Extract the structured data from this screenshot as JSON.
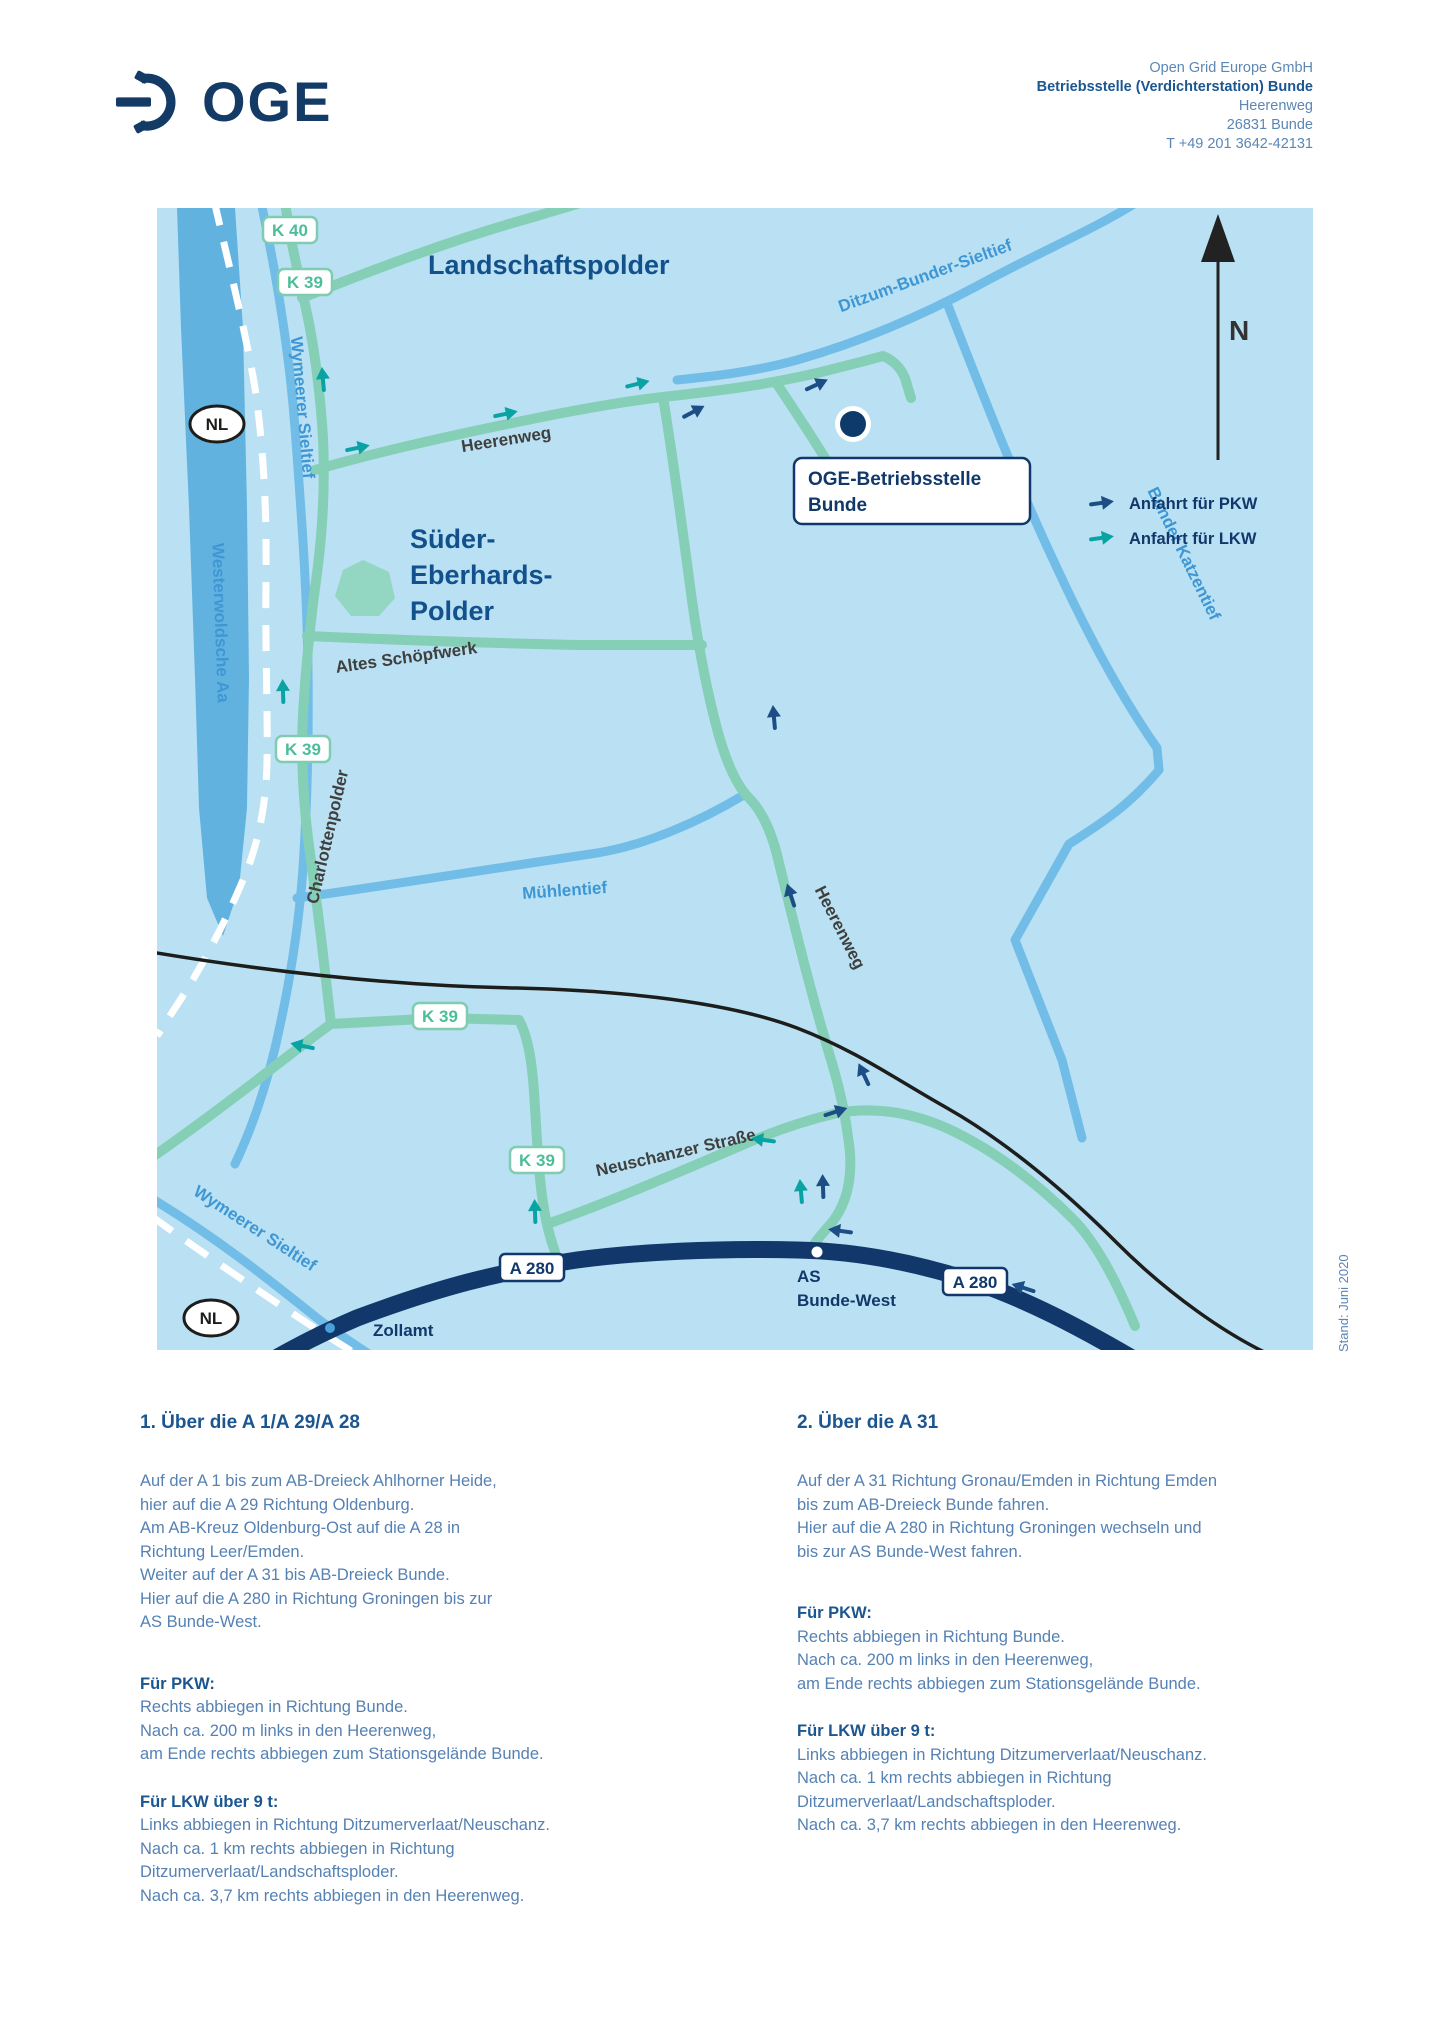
{
  "header": {
    "logo_text": "OGE",
    "address": {
      "line1": "Open Grid Europe GmbH",
      "line2": "Betriebsstelle (Verdichterstation) Bunde",
      "line3": "Heerenweg",
      "line4": "26831 Bunde",
      "line5": "T +49 201 3642-42131"
    }
  },
  "map": {
    "compass_label": "N",
    "legend": {
      "pkw": "Anfahrt für PKW",
      "lkw": "Anfahrt für LKW"
    },
    "region_labels": {
      "landschaftspolder": "Landschaftspolder",
      "sueder_line1": "Süder-",
      "sueder_line2": "Eberhards-",
      "sueder_line3": "Polder"
    },
    "water_labels": {
      "wymeerer_top": "Wymeerer Sieltief",
      "westerwoldsche": "Westerwoldsche Aa",
      "ditzum": "Ditzum-Bunder-Sieltief",
      "katzentief": "Bunder Katzentief",
      "muehlentief": "Mühlentief",
      "wymeerer_bottom": "Wymeerer Sieltief"
    },
    "street_labels": {
      "heerenweg_west": "Heerenweg",
      "heerenweg_south": "Heerenweg",
      "altes_schoepfwerk": "Altes Schöpfwerk",
      "charlottenpolder": "Charlottenpolder",
      "neuschanzer": "Neuschanzer Straße"
    },
    "badges": {
      "k40": "K 40",
      "k39_1": "K 39",
      "k39_2": "K 39",
      "k39_3": "K 39",
      "k39_4": "K 39",
      "a280_1": "A 280",
      "a280_2": "A 280",
      "nl_top": "NL",
      "nl_bottom": "NL"
    },
    "poi": {
      "facility_line1": "OGE-Betriebsstelle",
      "facility_line2": "Bunde",
      "zollamt": "Zollamt",
      "as_line1": "AS",
      "as_line2": "Bunde-West"
    },
    "stand_note": "Stand: Juni 2020"
  },
  "directions": {
    "sections": [
      {
        "heading": "1. Über die A 1/A 29/A 28",
        "intro_lines": [
          "Auf der A 1 bis zum AB-Dreieck Ahlhorner Heide,",
          "hier auf die A 29 Richtung Oldenburg.",
          "Am AB-Kreuz Oldenburg-Ost auf die A 28 in",
          "Richtung Leer/Emden.",
          "Weiter auf der A 31 bis AB-Dreieck Bunde.",
          "Hier auf die A 280 in Richtung Groningen bis zur",
          "AS Bunde-West."
        ],
        "pkw_title": "Für PKW:",
        "pkw_lines": [
          "Rechts abbiegen in Richtung Bunde.",
          "Nach ca. 200 m links in den Heerenweg,",
          "am Ende rechts abbiegen zum Stationsgelände Bunde."
        ],
        "lkw_title": "Für LKW über 9 t:",
        "lkw_lines": [
          "Links abbiegen in Richtung Ditzumerverlaat/Neuschanz.",
          "Nach ca. 1 km rechts abbiegen in Richtung",
          "Ditzumerverlaat/Landschaftsploder.",
          "Nach ca. 3,7 km rechts abbiegen in den Heerenweg."
        ]
      },
      {
        "heading": "2. Über die A 31",
        "intro_lines": [
          "Auf der A 31 Richtung Gronau/Emden in Richtung Emden",
          "bis zum AB-Dreieck Bunde fahren.",
          "Hier auf die A 280 in Richtung Groningen wechseln und",
          "bis zur AS Bunde-West fahren."
        ],
        "pkw_title": "Für PKW:",
        "pkw_lines": [
          "Rechts abbiegen in Richtung Bunde.",
          "Nach ca. 200 m links in den Heerenweg,",
          "am Ende rechts abbiegen zum Stationsgelände Bunde."
        ],
        "lkw_title": "Für LKW über 9 t:",
        "lkw_lines": [
          "Links abbiegen in Richtung Ditzumerverlaat/Neuschanz.",
          "Nach ca. 1 km rechts abbiegen in Richtung",
          "Ditzumerverlaat/Landschaftsploder.",
          "Nach ca. 3,7 km rechts abbiegen in den Heerenweg."
        ]
      }
    ]
  },
  "colors": {
    "brand_navy": "#143a66",
    "heading_blue": "#1b5690",
    "body_blue": "#5581b3",
    "map_background": "#b9e1f3",
    "road_green": "#85cfb6",
    "river_blue": "#72bde8",
    "motorway_navy": "#12386b",
    "pkw_arrow_navy": "#1c4e85",
    "lkw_arrow_teal": "#0aa3a3"
  }
}
